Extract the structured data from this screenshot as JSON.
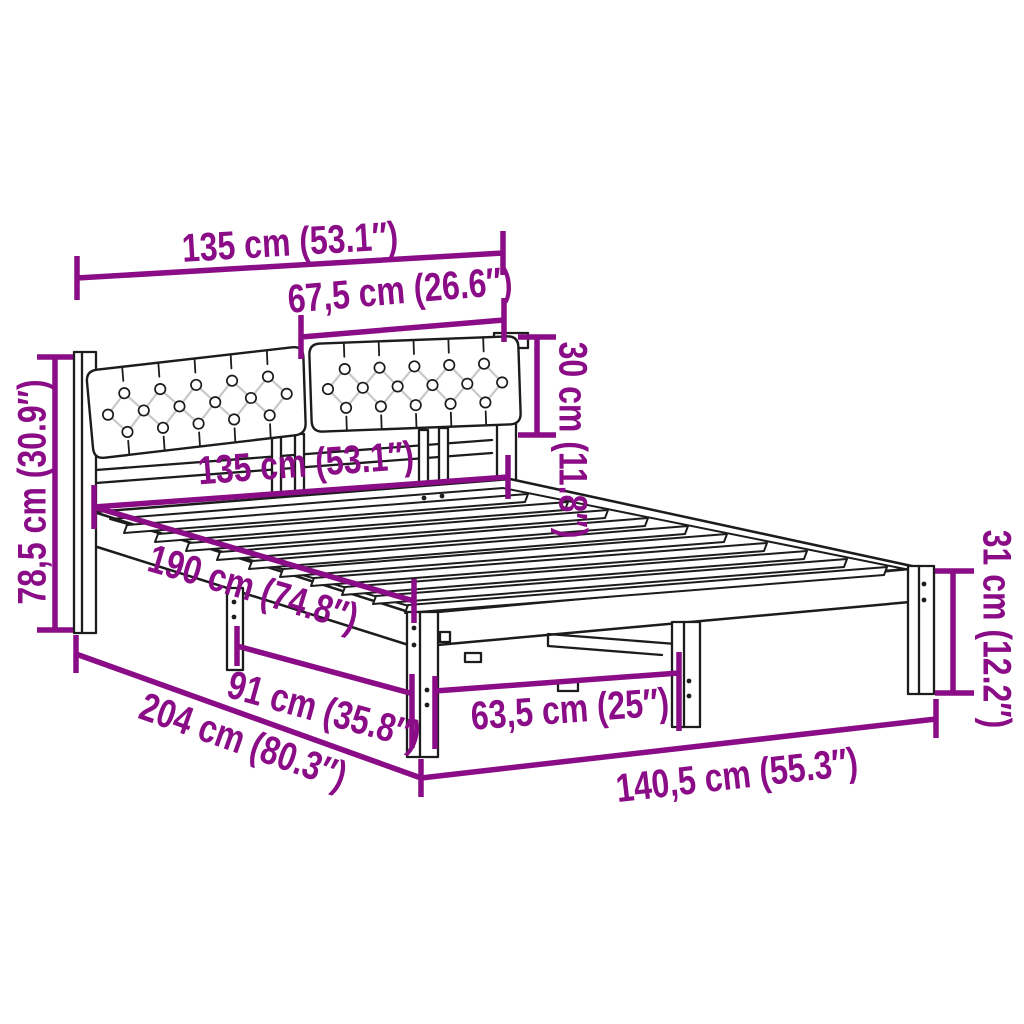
{
  "page": {
    "background": "#ffffff",
    "width": 1024,
    "height": 1024
  },
  "diagram": {
    "subject": "bed-frame-with-upholstered-headboard-dimension-diagram",
    "accent_color": "#8A0C86",
    "line_color": "#1c1c1c",
    "dimensions": {
      "headboard_width": "135 cm (53.1″)",
      "cushion_width": "67,5 cm (26.6″)",
      "cushion_height": "30 cm (11.8″)",
      "headboard_height": "78,5 cm (30.9″)",
      "bed_width": "135 cm (53.1″)",
      "bed_length": "190 cm (74.8″)",
      "side_leg_spacing": "91 cm (35.8″)",
      "overall_length": "204 cm (80.3″)",
      "front_leg_spacing": "63,5 cm (25″)",
      "overall_width": "140,5 cm (55.3″)",
      "foot_leg_height": "31 cm (12.2″)"
    }
  }
}
